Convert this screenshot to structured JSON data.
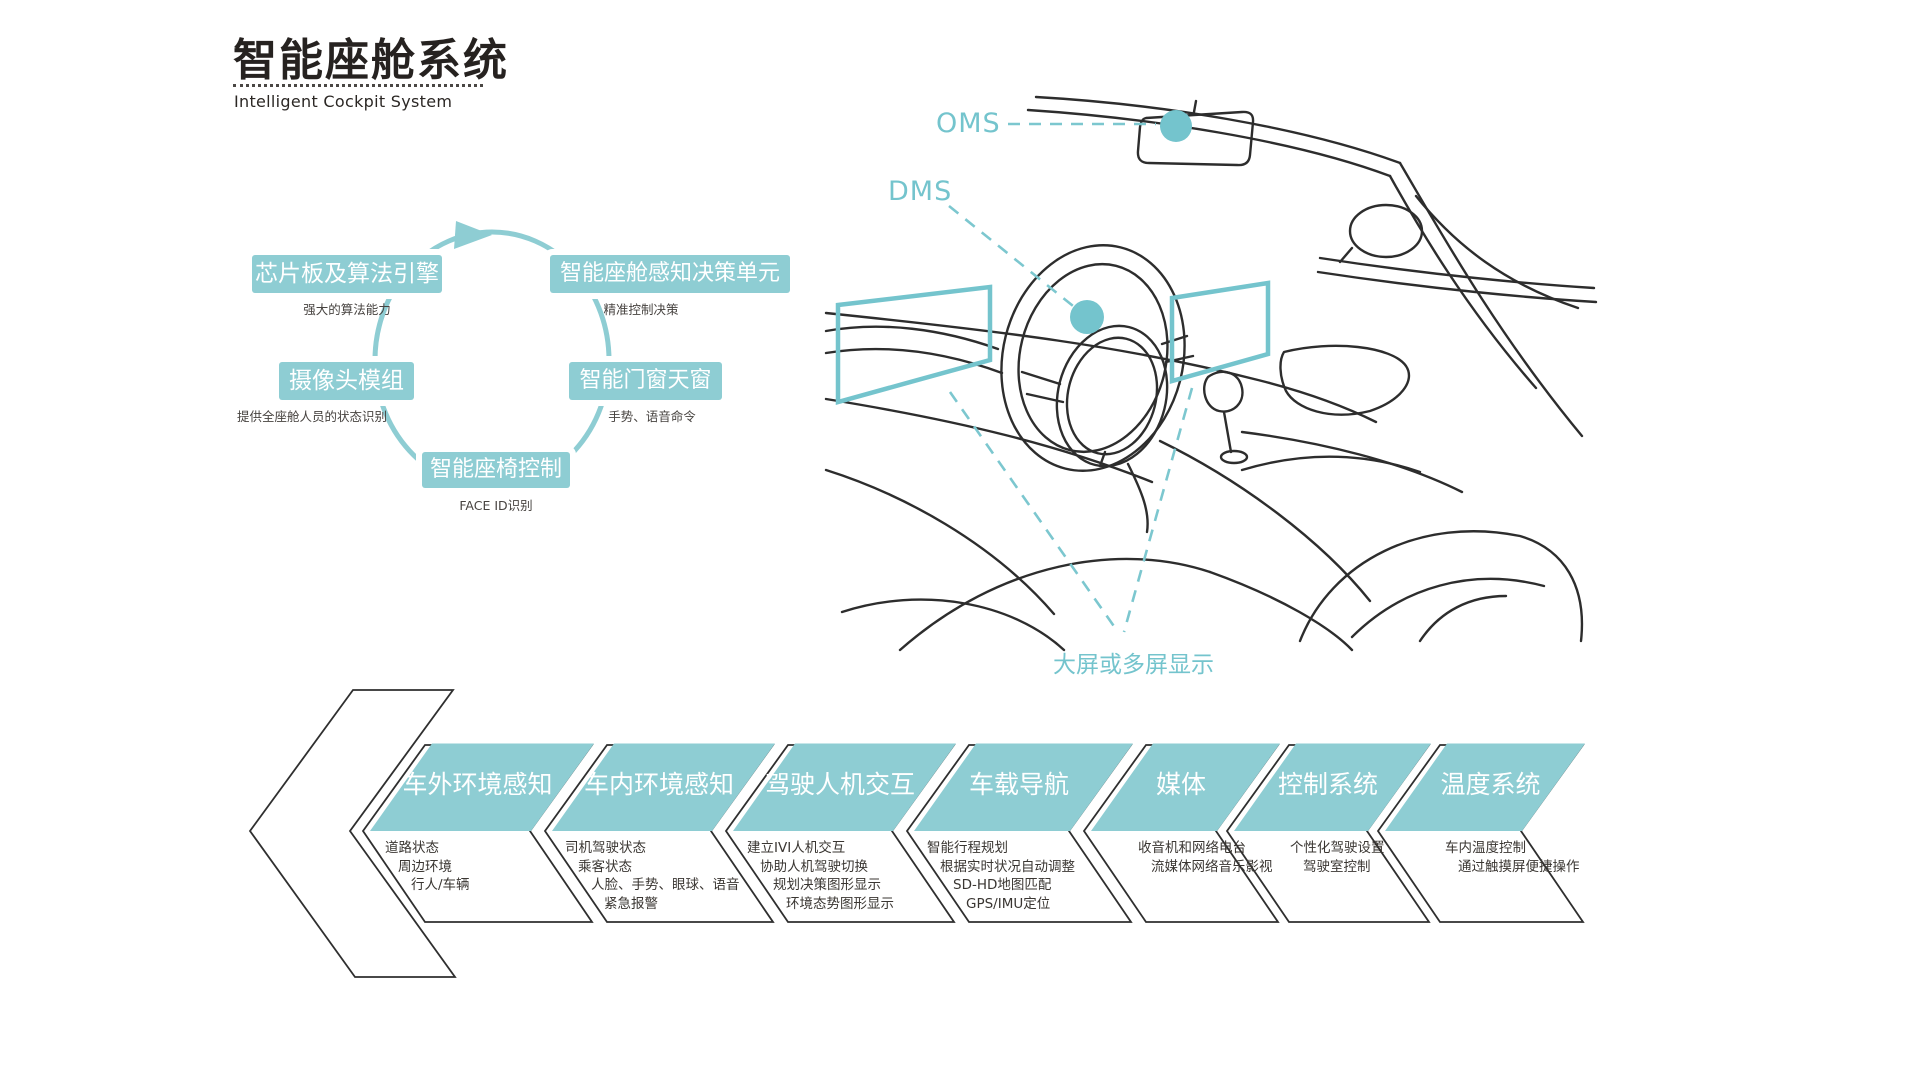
{
  "header": {
    "title": "智能座舱系统",
    "subtitle": "Intelligent Cockpit System"
  },
  "cycle": {
    "nodes": [
      {
        "label": "芯片板及算法引擎",
        "note": "强大的算法能力"
      },
      {
        "label": "智能座舱感知决策单元",
        "note": "精准控制决策"
      },
      {
        "label": "摄像头模组",
        "note": "提供全座舱人员的状态识别"
      },
      {
        "label": "智能门窗天窗",
        "note": "手势、语音命令"
      },
      {
        "label": "智能座椅控制",
        "note": "FACE ID识别"
      }
    ]
  },
  "car": {
    "labels": {
      "oms": "OMS",
      "dms": "DMS",
      "display": "大屏或多屏显示"
    }
  },
  "flow": {
    "steps": [
      {
        "title": "车外环境感知",
        "items": [
          "道路状态",
          "周边环境",
          "行人/车辆"
        ]
      },
      {
        "title": "车内环境感知",
        "items": [
          "司机驾驶状态",
          "乘客状态",
          "人脸、手势、眼球、语音",
          "紧急报警"
        ]
      },
      {
        "title": "驾驶人机交互",
        "items": [
          "建立IVI人机交互",
          "协助人机驾驶切换",
          "规划决策图形显示",
          "环境态势图形显示"
        ]
      },
      {
        "title": "车载导航",
        "items": [
          "智能行程规划",
          "根据实时状况自动调整",
          "SD-HD地图匹配",
          "GPS/IMU定位"
        ]
      },
      {
        "title": "媒体",
        "items": [
          "收音机和网络电台",
          "流媒体网络音乐影视"
        ]
      },
      {
        "title": "控制系统",
        "items": [
          "个性化驾驶设置",
          "驾驶室控制"
        ]
      },
      {
        "title": "温度系统",
        "items": [
          "车内温度控制",
          "通过触摸屏便捷操作"
        ]
      }
    ]
  },
  "colors": {
    "teal_fill": "#8ecdd3",
    "teal_accent": "#74c4cd",
    "ink": "#2d2d2d"
  }
}
